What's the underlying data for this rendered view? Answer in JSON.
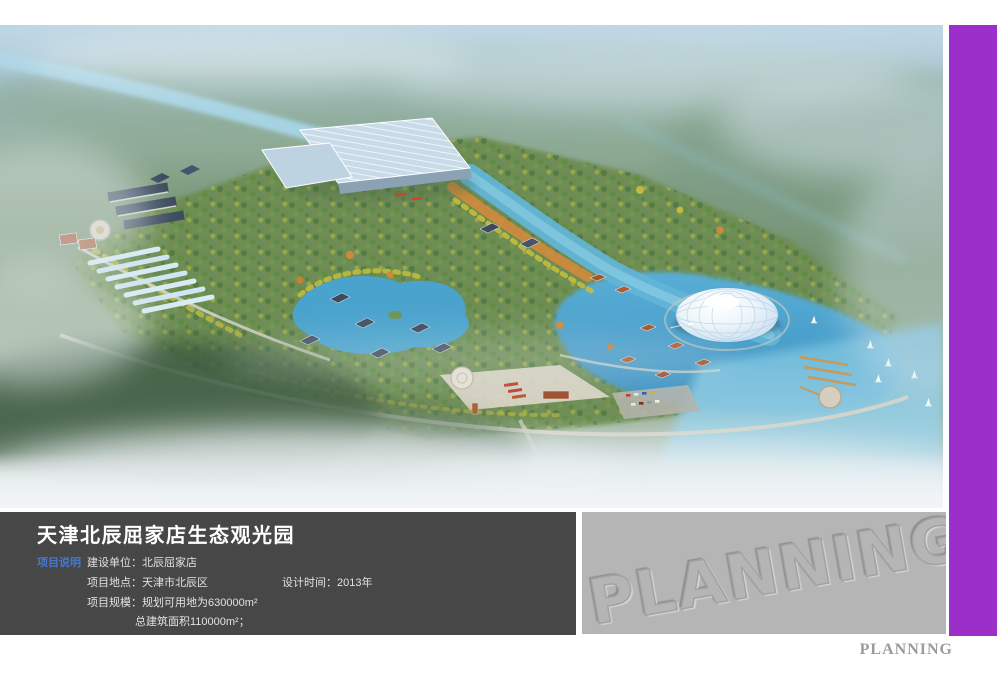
{
  "info_panel": {
    "title": "天津北辰屈家店生态观光园",
    "section_label": "项目说明",
    "construction_unit_label": "建设单位：",
    "construction_unit_value": "北辰屈家店",
    "location_label": "项目地点：",
    "location_value": "天津市北辰区",
    "design_time_label": "设计时间：",
    "design_time_value": "2013年",
    "scale_label": "项目规模：",
    "scale_value": "规划可用地为630000m²",
    "total_area_value": "总建筑面积110000m²；"
  },
  "watermarks": {
    "box_watermark": "PLANNING",
    "footer_watermark": "PLANNING"
  },
  "colors": {
    "accent_purple": "#9c2fc9",
    "panel_background": "#474747",
    "section_label_blue": "#4577cd",
    "watermark_box_gray": "#b5b5b5",
    "footer_text_gray": "#9b9b9b",
    "water_blue": "#4aa3cd",
    "park_green": "#6e8d55"
  }
}
